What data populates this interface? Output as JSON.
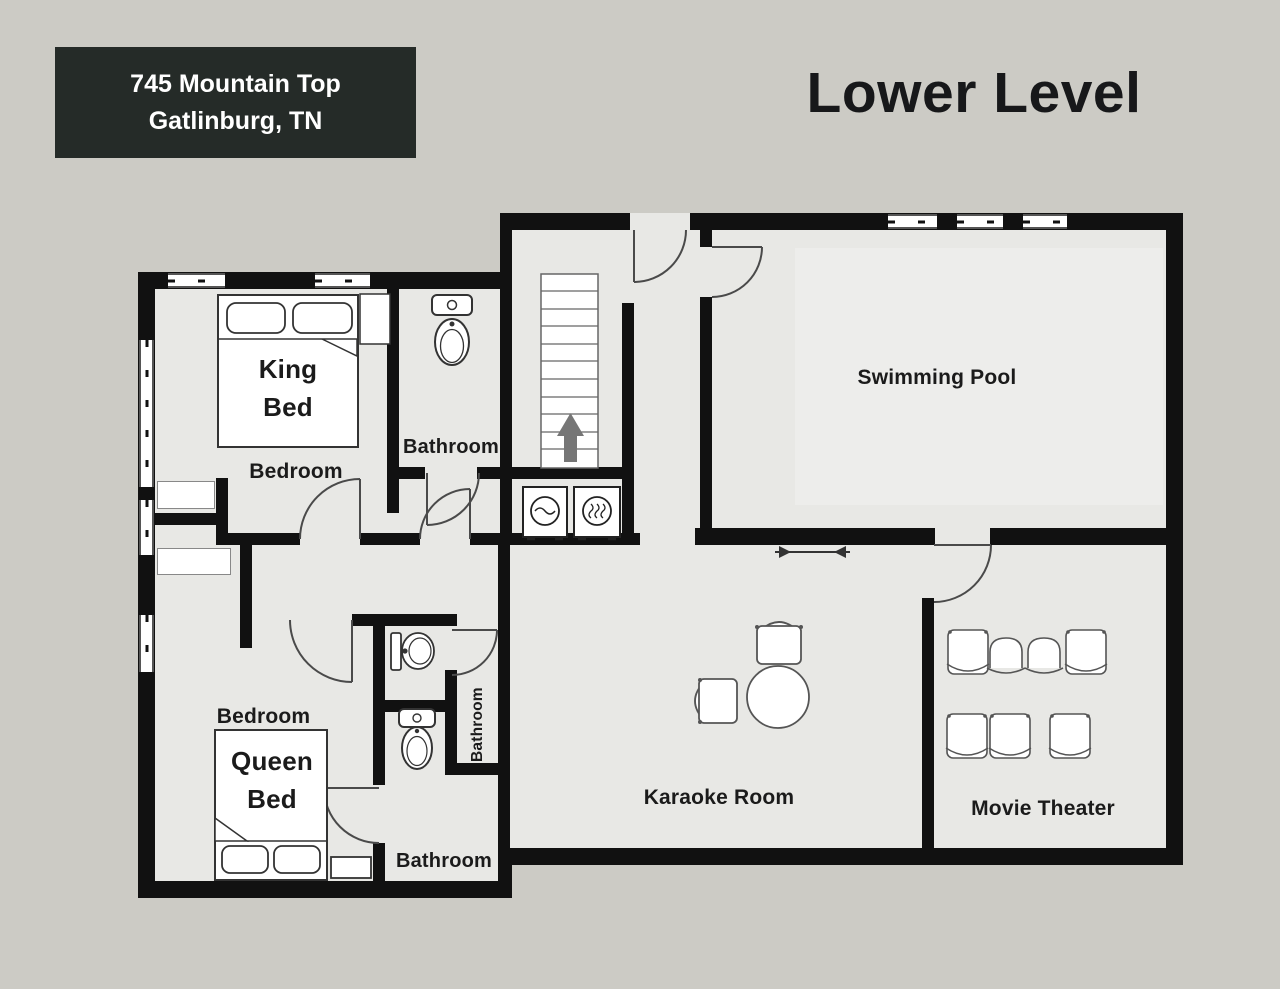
{
  "header": {
    "address_line1": "745 Mountain Top",
    "address_line2": "Gatlinburg, TN",
    "title": "Lower Level"
  },
  "rooms": {
    "bedroom_king": {
      "label": "Bedroom",
      "bed": "King Bed"
    },
    "bedroom_queen": {
      "label": "Bedroom",
      "bed": "Queen Bed"
    },
    "bathroom_upper": {
      "label": "Bathroom"
    },
    "bathroom_middle": {
      "label": "Bathroom"
    },
    "bathroom_lower": {
      "label": "Bathroom"
    },
    "swimming_pool": {
      "label": "Swimming Pool"
    },
    "karaoke_room": {
      "label": "Karaoke Room"
    },
    "movie_theater": {
      "label": "Movie Theater"
    }
  },
  "icons": [
    "stairs-up-icon",
    "washer-icon",
    "dryer-icon",
    "toilet-icon",
    "sink-icon",
    "king-bed-icon",
    "queen-bed-icon",
    "round-table-icon",
    "chair-icon",
    "theater-seat-icon",
    "door-arc-icon",
    "window-icon",
    "sliding-door-arrow-icon"
  ],
  "colors": {
    "background": "#cccbc5",
    "floor": "#e8e8e5",
    "wall": "#111111",
    "address_box_bg": "#252b28",
    "address_text": "#ffffff",
    "title_text": "#17181a",
    "label_text": "#1b1b1b",
    "pool_water": "#ededeb"
  }
}
